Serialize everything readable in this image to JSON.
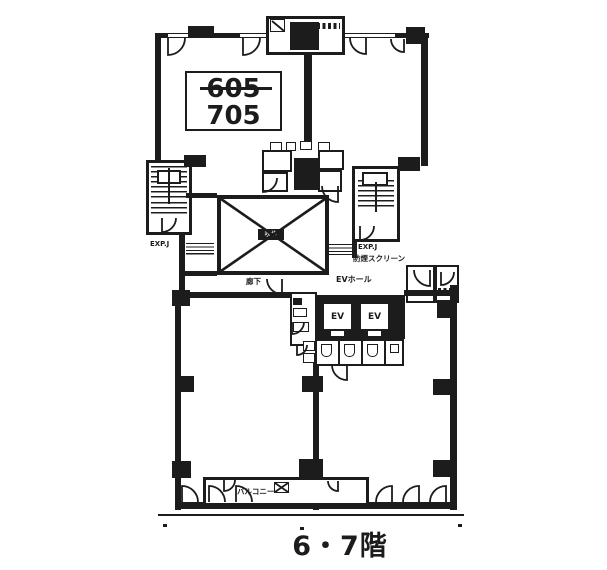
{
  "plan": {
    "caption": "6・7階",
    "unit_box": {
      "old_number": "605",
      "new_number": "705"
    },
    "labels": {
      "void": "吹抜",
      "exp_joint_left": "EXP.J",
      "exp_joint_right": "EXP.J",
      "smoke_screen": "防煙スクリーン",
      "ev_hall": "EVホール",
      "elevator_1": "EV",
      "elevator_2": "EV",
      "corridor": "廊下",
      "balcony": "バルコニー"
    },
    "colors": {
      "ink": "#1c1c1c",
      "background": "#ffffff"
    }
  }
}
